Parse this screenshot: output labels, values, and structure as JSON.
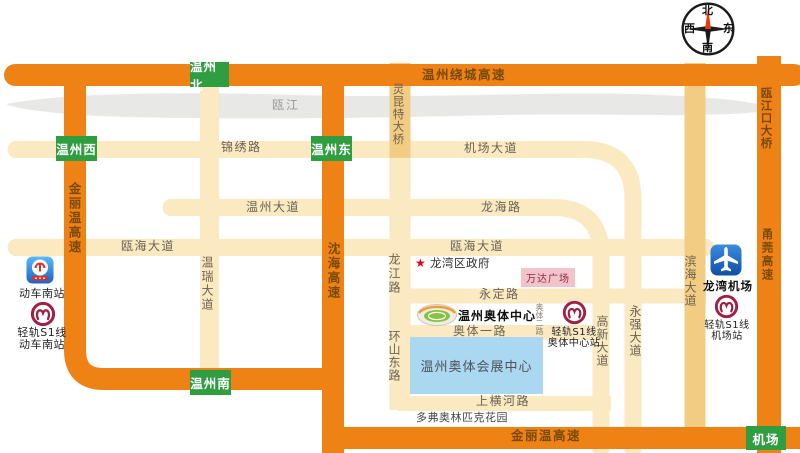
{
  "compass": {
    "north": "北",
    "south": "南",
    "east": "东",
    "west": "西"
  },
  "river": {
    "name": "瓯江"
  },
  "highways": {
    "raocheng": "温州绕城高速",
    "jinliwen_left": "金丽温高速",
    "jinliwen_bottom": "金丽温高速",
    "shenhai": "沈海高速",
    "yongguan": "甬莞高速",
    "oujiangkou_bridge": "瓯江口大桥",
    "lingkun_bridge": "灵昆特大桥"
  },
  "exits": {
    "north": "温州北",
    "west": "温州西",
    "east": "温州东",
    "south": "温州南",
    "airport": "机场"
  },
  "roads": {
    "jinxiu": "锦绣路",
    "airport_avenue": "机场大道",
    "wenzhou_avenue": "温州大道",
    "longhai": "龙海路",
    "ouhai_avenue_west": "瓯海大道",
    "ouhai_avenue_mid": "瓯海大道",
    "yongding": "永定路",
    "aoti_road_1": "奥体一路",
    "aoti_road_2": "奥体二路",
    "shanghenghe": "上横河路",
    "wenrui_avenue": "温瑞大道",
    "longjiang": "龙江路",
    "huanshan_east": "环山东路",
    "gaoxin_avenue": "高新大道",
    "yongqiang_avenue": "永强大道",
    "binhai_avenue": "滨海大道"
  },
  "places": {
    "train_south_station": "动车南站",
    "train_south_s1_line": "轻轨S1线",
    "train_south_s1_station": "动车南站",
    "longwan_government": "龙湾区政府",
    "wanda_plaza": "万达广场",
    "olympic_center": "温州奥体中心",
    "aoti_s1_line": "轻轨S1线",
    "aoti_s1_station": "奥体中心站",
    "expo_center": "温州奥体会展中心",
    "dove_olympic_garden": "多弗奥林匹克花园",
    "longwan_airport": "龙湾机场",
    "airport_s1_line": "轻轨S1线",
    "airport_s1_station": "机场站"
  },
  "colors": {
    "highway_orange": "#EF8214",
    "road_cream": "#FAE9C1",
    "road_tan": "#F2CC82",
    "river_gray": "#E8E8E7",
    "exit_green": "#2F9E41",
    "highway_text": "#7A4A08",
    "road_text": "#6B6250",
    "s1_logo_red": "#A02045",
    "railway_icon_blue": "#2E86D9",
    "airport_icon_blue": "#1565C8",
    "wanda_pink": "#F2C3CB",
    "expo_blue": "#A9D8F0",
    "star_red": "#E60012"
  }
}
